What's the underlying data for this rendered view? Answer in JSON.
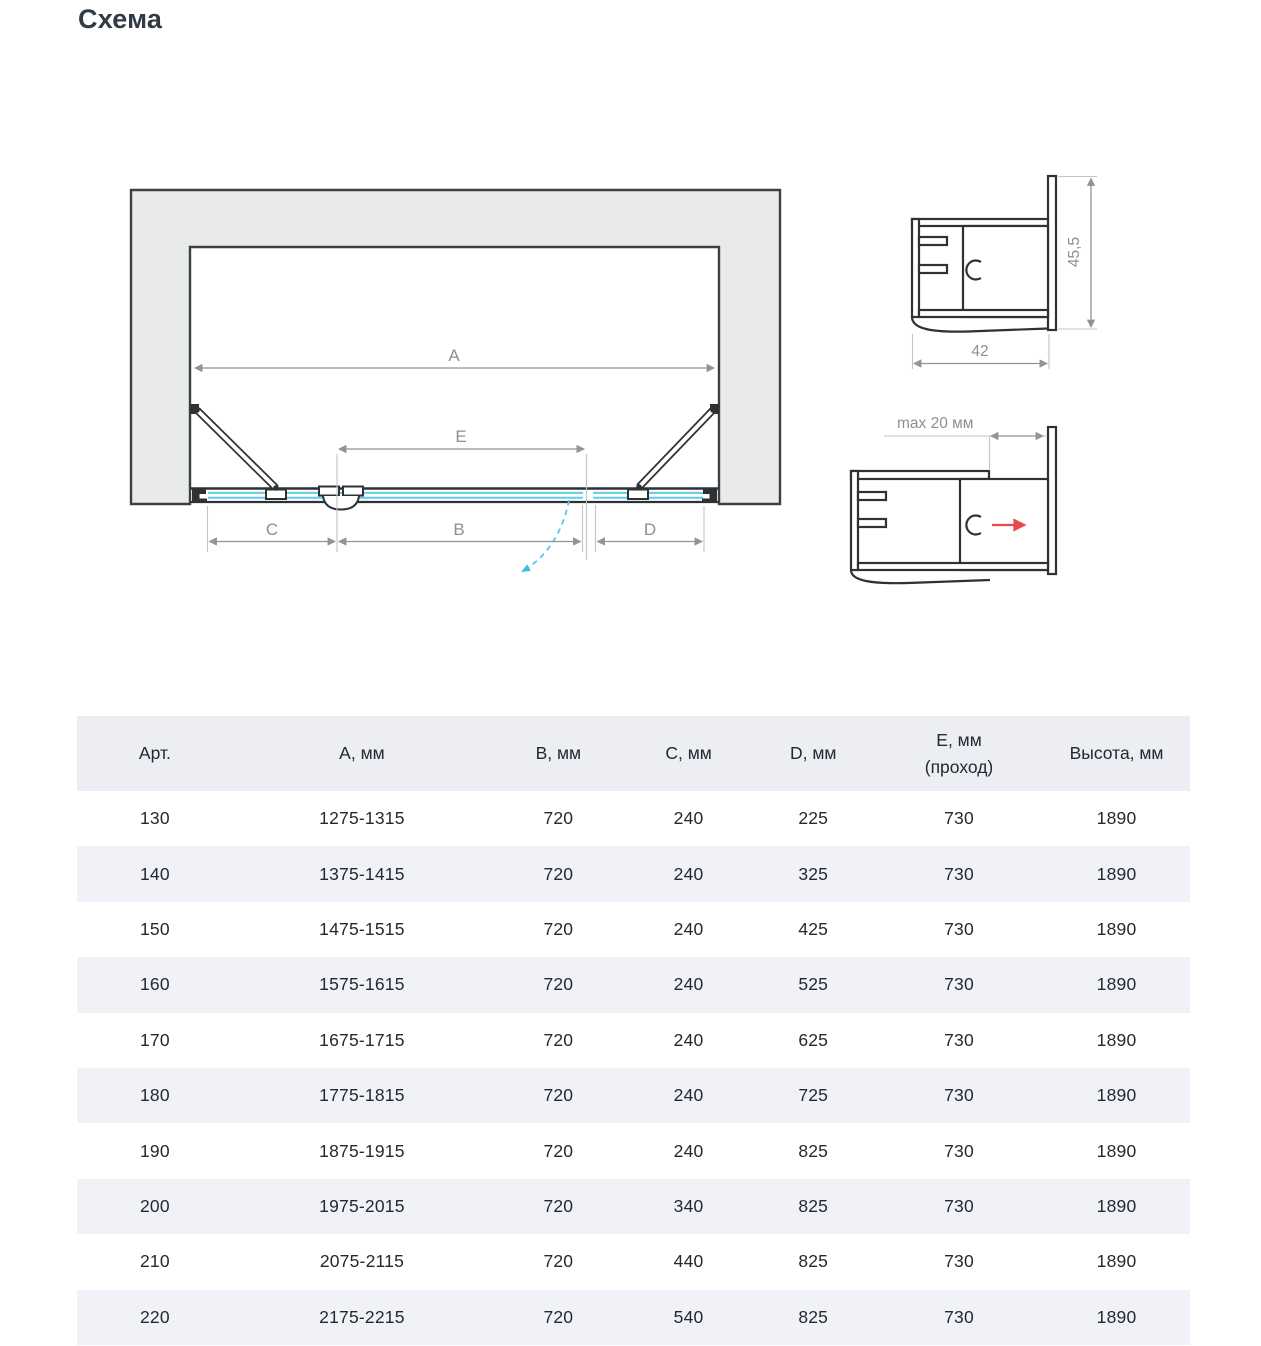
{
  "page_title": "Схема",
  "diagram": {
    "plan": {
      "dim_a": "A",
      "dim_b": "B",
      "dim_c": "C",
      "dim_d": "D",
      "dim_e": "E"
    },
    "profile_corner": {
      "width": "42",
      "height": "45,5"
    },
    "profile_wall": {
      "adjustment": "max 20 мм"
    },
    "colors": {
      "glass": "#62cbee",
      "swing_arc": "#49bfe9",
      "adjust_arrow": "#e8474f",
      "wall_fill": "#e9eaea",
      "outline": "#2e3235",
      "dimension": "#8f9499"
    }
  },
  "table": {
    "columns": [
      {
        "label": "Арт.",
        "sublabel": ""
      },
      {
        "label": "А, мм",
        "sublabel": ""
      },
      {
        "label": "В, мм",
        "sublabel": ""
      },
      {
        "label": "С, мм",
        "sublabel": ""
      },
      {
        "label": "D, мм",
        "sublabel": ""
      },
      {
        "label": "Е, мм",
        "sublabel": "(проход)"
      },
      {
        "label": "Высота, мм",
        "sublabel": ""
      }
    ],
    "rows": [
      [
        "130",
        "1275-1315",
        "720",
        "240",
        "225",
        "730",
        "1890"
      ],
      [
        "140",
        "1375-1415",
        "720",
        "240",
        "325",
        "730",
        "1890"
      ],
      [
        "150",
        "1475-1515",
        "720",
        "240",
        "425",
        "730",
        "1890"
      ],
      [
        "160",
        "1575-1615",
        "720",
        "240",
        "525",
        "730",
        "1890"
      ],
      [
        "170",
        "1675-1715",
        "720",
        "240",
        "625",
        "730",
        "1890"
      ],
      [
        "180",
        "1775-1815",
        "720",
        "240",
        "725",
        "730",
        "1890"
      ],
      [
        "190",
        "1875-1915",
        "720",
        "240",
        "825",
        "730",
        "1890"
      ],
      [
        "200",
        "1975-2015",
        "720",
        "340",
        "825",
        "730",
        "1890"
      ],
      [
        "210",
        "2075-2115",
        "720",
        "440",
        "825",
        "730",
        "1890"
      ],
      [
        "220",
        "2175-2215",
        "720",
        "540",
        "825",
        "730",
        "1890"
      ]
    ]
  }
}
